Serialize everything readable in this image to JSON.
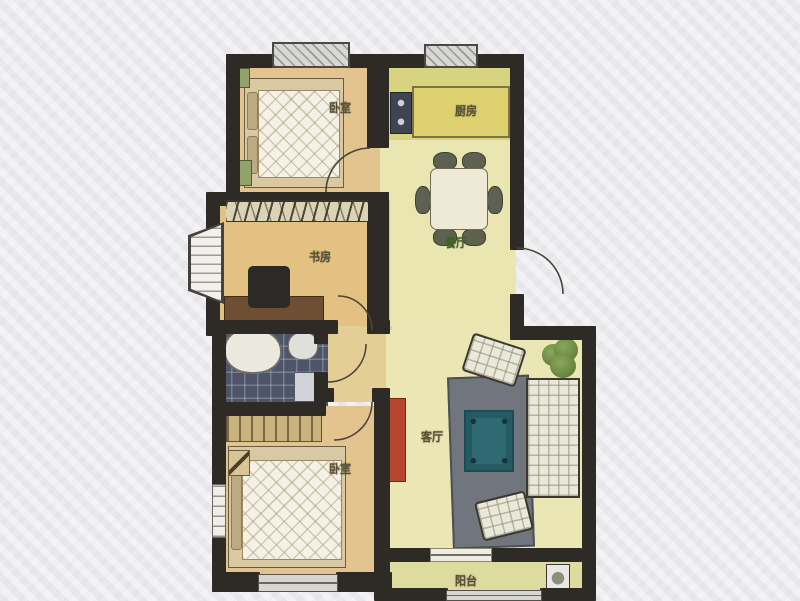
{
  "meta": {
    "type": "apartment-floor-plan"
  },
  "palette": {
    "background": "#ebebed",
    "wall": "#2e2a26",
    "floor-bedroom": "#e4c48e",
    "floor-study": "#e3c183",
    "floor-kitchen": "#d8d37f",
    "floor-dining": "#e9e6b2",
    "floor-living": "#eae7b4",
    "floor-corridor": "#e3cf96",
    "floor-balcony": "#dedb9e",
    "floor-bathroom": "#4e5569",
    "door-arc": "#4a443c",
    "rug": "#71757d",
    "coffee-table": "#2f6a72",
    "tv-cabinet": "#b8452e",
    "sofa": "#eae8d8",
    "bed-quilt": "#f4f1e6",
    "bed-frame": "#d9c9a2",
    "counter": "#ddd06f",
    "stove": "#3e4452",
    "desk": "#6f4f33",
    "wardrobe": "#c8b27e",
    "label": "#5a5138",
    "label-dining": "#45622e"
  },
  "rooms": {
    "bedroom_top": {
      "label": "卧室"
    },
    "kitchen": {
      "label": "厨房"
    },
    "dining": {
      "label": "餐厅"
    },
    "study": {
      "label": "书房"
    },
    "bedroom_bottom": {
      "label": "卧室"
    },
    "living": {
      "label": "客厅"
    },
    "balcony": {
      "label": "阳台"
    }
  },
  "furniture": [
    "double-bed",
    "nightstand",
    "pillows",
    "kitchen-counter",
    "stove",
    "dining-table",
    "dining-chair",
    "desk",
    "computer-chair",
    "bay-window",
    "bathtub",
    "toilet",
    "sink",
    "wardrobe",
    "bedside-lamp",
    "tv-cabinet",
    "rug",
    "coffee-table",
    "armchair",
    "sofa",
    "plant",
    "washing-machine"
  ]
}
